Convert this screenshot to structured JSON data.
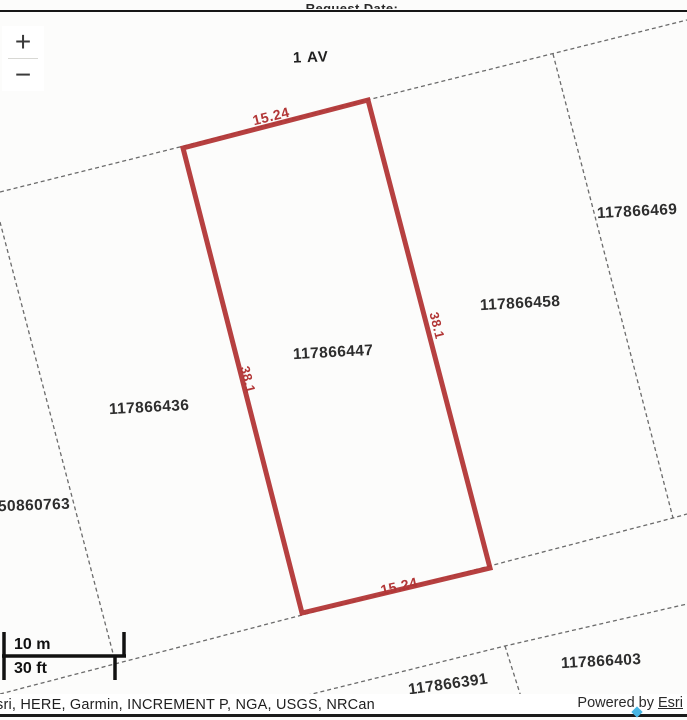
{
  "header": {
    "clipped_request_text": "Request Date: ..."
  },
  "controls": {
    "zoom_in_label": "+",
    "zoom_out_label": "−"
  },
  "map": {
    "street_label": "1 AV",
    "parcels": [
      {
        "id": "117866469"
      },
      {
        "id": "117866458"
      },
      {
        "id": "117866447"
      },
      {
        "id": "117866436"
      },
      {
        "id": "50860763"
      },
      {
        "id": "117866391"
      },
      {
        "id": "117866403"
      }
    ],
    "highlight": {
      "parcel_id": "117866447",
      "color": "#b23636",
      "dim_top": "15.24",
      "dim_bottom": "15.24",
      "dim_left": "38.1",
      "dim_right": "38.1"
    }
  },
  "scale_bar": {
    "metric": "10 m",
    "imperial": "30 ft"
  },
  "footer": {
    "attribution": "sri, HERE, Garmin, INCREMENT P, NGA, USGS, NRCan",
    "powered_by_prefix": "Powered by ",
    "powered_by_link": "Esri"
  }
}
